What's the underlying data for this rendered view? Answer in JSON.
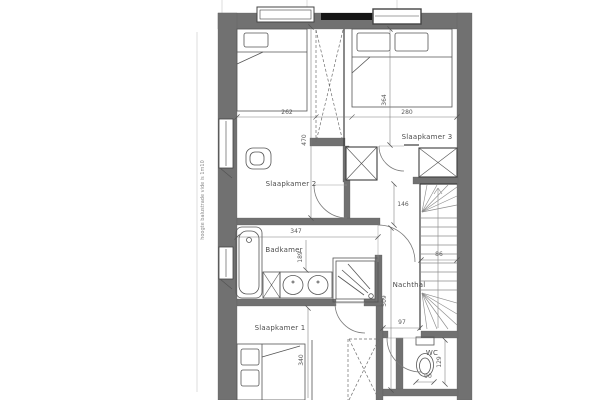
{
  "floorplan": {
    "note_left": "hoogte balustrade vide is 1m10",
    "rooms": {
      "slaapkamer1": {
        "label": "Slaapkamer 1"
      },
      "slaapkamer2": {
        "label": "Slaapkamer 2"
      },
      "slaapkamer3": {
        "label": "Slaapkamer 3"
      },
      "badkamer": {
        "label": "Badkamer"
      },
      "nachthal": {
        "label": "Nachthal"
      },
      "wc": {
        "label": "WC"
      }
    },
    "dimensions": {
      "slaapkamer2_width": "262",
      "slaapkamer2_depth": "470",
      "slaapkamer3_width": "280",
      "slaapkamer3_depth": "364",
      "badkamer_width": "347",
      "badkamer_depth": "189",
      "hal_width": "146",
      "hal_length": "509",
      "stair_width": "86",
      "hal_bottom_width": "97",
      "slaapkamer1_depth": "340",
      "wc_width": "90",
      "wc_depth": "129"
    },
    "colors": {
      "wall": "#717171",
      "beam": "#161616"
    }
  }
}
